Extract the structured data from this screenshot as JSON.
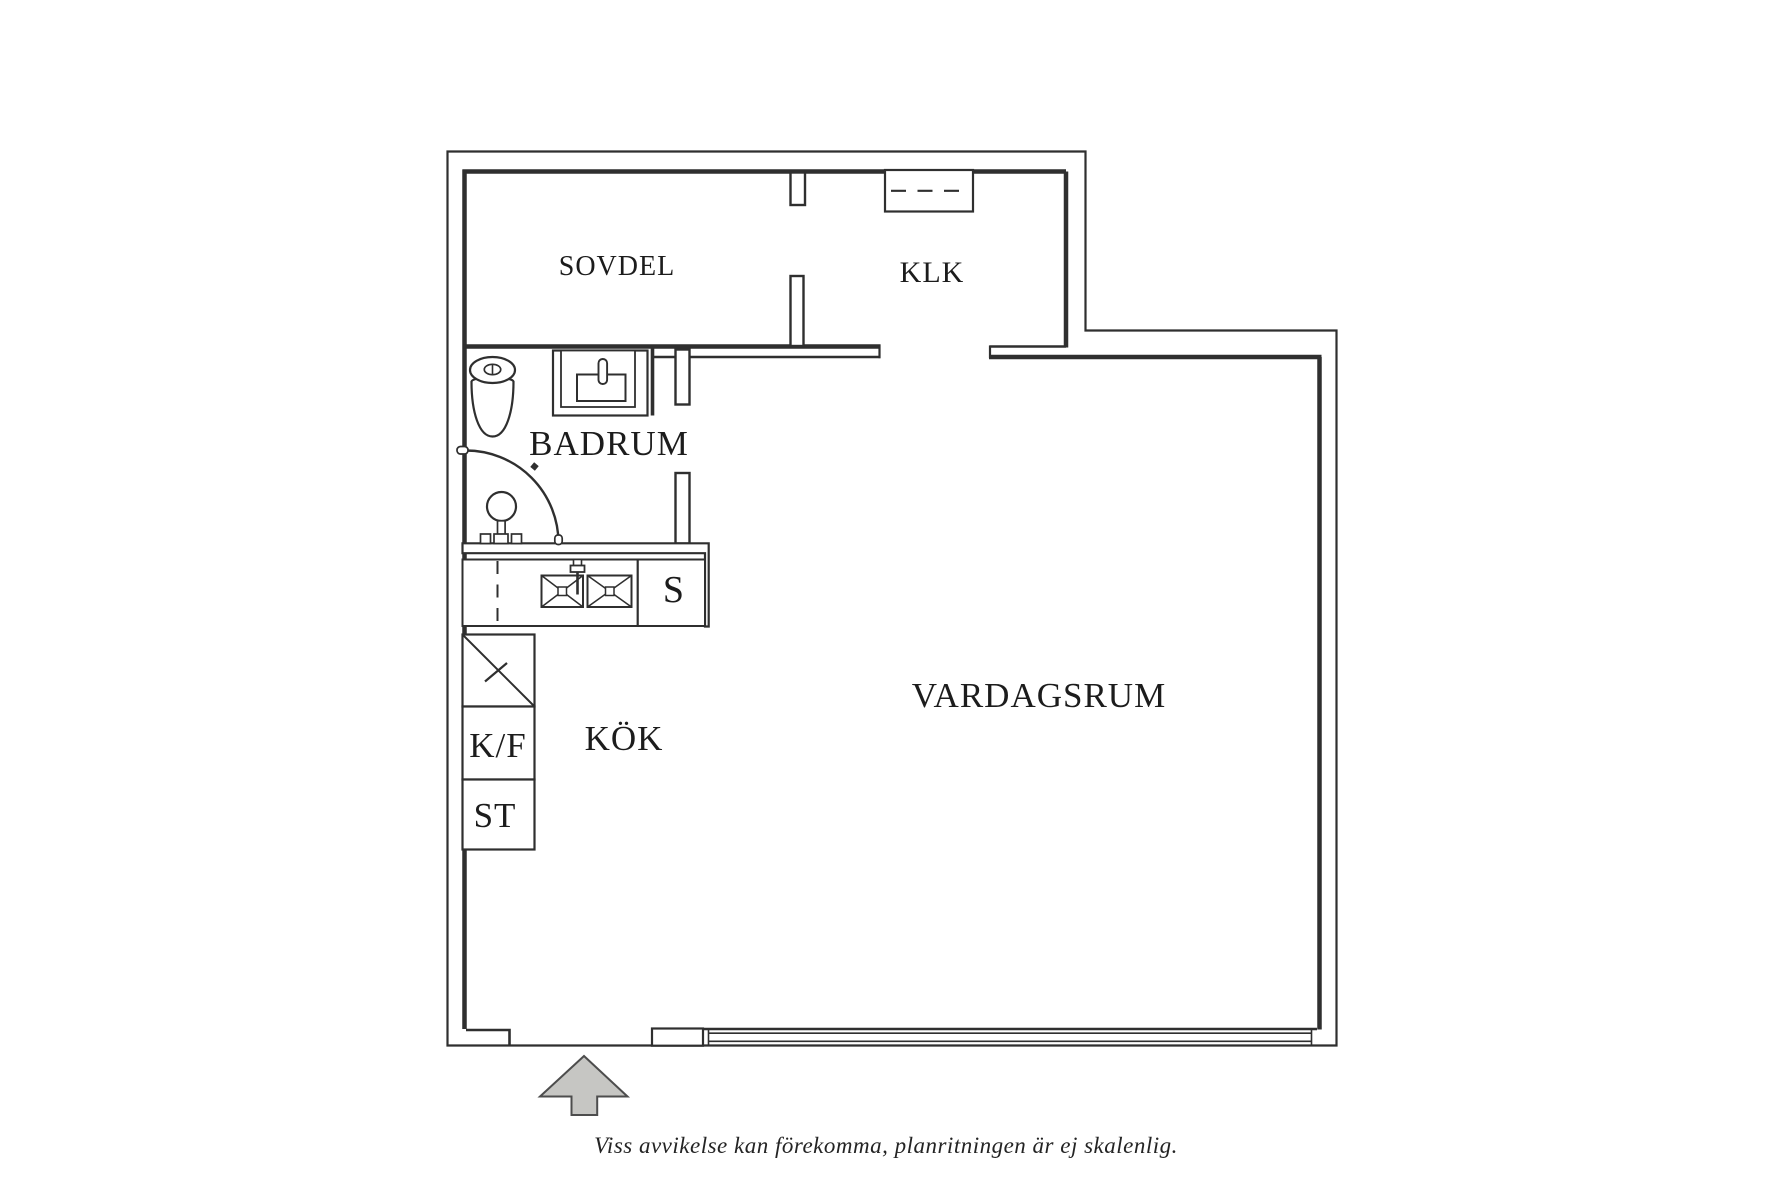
{
  "rooms": {
    "sovdel": "SOVDEL",
    "klk": "KLK",
    "badrum": "BADRUM",
    "kok": "KÖK",
    "vardagsrum": "VARDAGSRUM"
  },
  "cabinets": {
    "kf": "K/F",
    "st": "ST",
    "s": "S"
  },
  "fixtures": {
    "toilet": "toilet-icon",
    "bathroom_sink": "bathroom-sink-icon",
    "shower": "shower-icon",
    "kitchen_sink": "double-kitchen-sink-icon",
    "dishwasher_dashed": "dishwasher-dashed-line",
    "tall_cabinet": "tall-cabinet-diagonal",
    "wardrobe": "wardrobe-dashed-icon",
    "window": "window-band",
    "entrance_arrow": "entrance-arrow-icon"
  },
  "footer": {
    "disclaimer": "Viss avvikelse kan förekomma, planritningen är ej skalenlig."
  },
  "colors": {
    "wall": "#2f2f2f",
    "text": "#1c1c1c",
    "arrow_fill": "#c6c6c3",
    "arrow_stroke": "#4d4d4d",
    "background": "#ffffff"
  }
}
